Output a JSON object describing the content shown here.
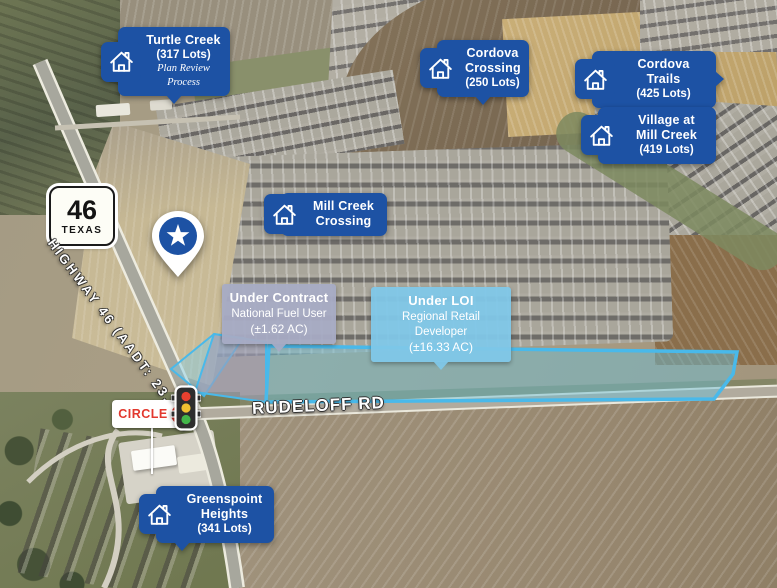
{
  "communities": [
    {
      "name": "Turtle Creek",
      "lots": "(317 Lots)",
      "note": "Plan Review Process"
    },
    {
      "name": "Cordova Crossing",
      "lots": "(250 Lots)"
    },
    {
      "name": "Cordova Trails",
      "lots": "(425 Lots)"
    },
    {
      "name": "Village at Mill Creek",
      "lots": "(419 Lots)"
    },
    {
      "name": "Mill Creek Crossing",
      "lots": ""
    },
    {
      "name": "Greenspoint Heights",
      "lots": "(341 Lots)"
    }
  ],
  "parcels": [
    {
      "status": "Under Contract",
      "party": "National Fuel User",
      "area": "(±1.62 AC)"
    },
    {
      "status": "Under LOI",
      "party": "Regional Retail Developer",
      "area": "(±16.33 AC)"
    }
  ],
  "roads": {
    "shield_number": "46",
    "shield_state": "TEXAS",
    "highway_label": "HIGHWAY 46 (AADT: 23,000)",
    "cross_street": "RUDELOFF RD"
  },
  "poi": {
    "circle_k_word": "CIRCLE",
    "circle_k_letter": "K"
  },
  "colors": {
    "brand_blue": "#1d52a4",
    "parcel_outline": "#49b9ea",
    "under_contract_fill": "#a7abc4",
    "under_loi_fill": "#7fc7e8",
    "circle_k_red": "#e2382e"
  }
}
